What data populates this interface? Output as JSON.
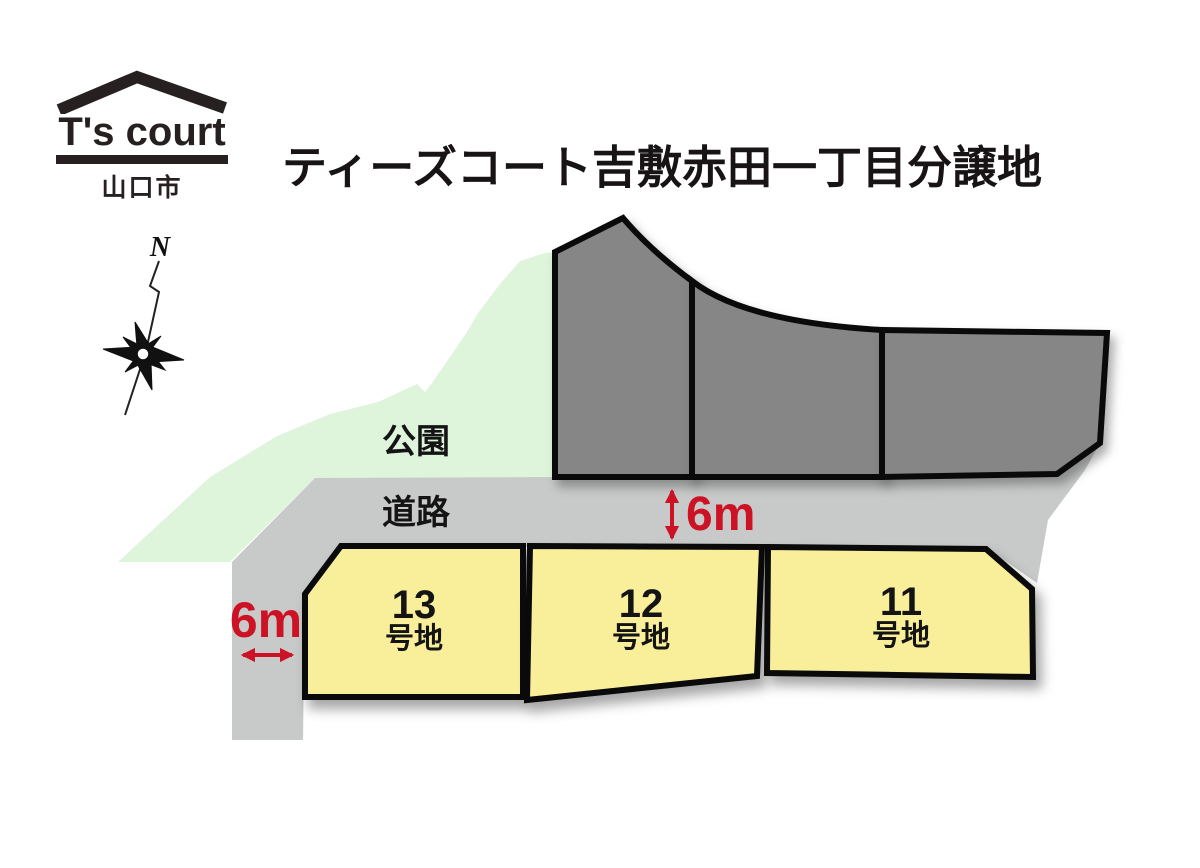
{
  "logo": {
    "brand": "T's court",
    "city": "山口市"
  },
  "title": "ティーズコート吉敷赤田一丁目分譲地",
  "compass": {
    "north_label": "N"
  },
  "map": {
    "park_label": "公園",
    "road_label": "道路",
    "road_width_label": "6m",
    "side_road_width_label": "6m",
    "lots": [
      {
        "number": "13",
        "suffix": "号地"
      },
      {
        "number": "12",
        "suffix": "号地"
      },
      {
        "number": "11",
        "suffix": "号地"
      }
    ],
    "colors": {
      "lot_fill": "#f9ee9a",
      "lot_outline": "#0a0a0a",
      "reserved_lot_fill": "#868686",
      "road_fill": "#c8cac9",
      "park_fill": "#def5dc",
      "dimension_red": "#cd1225"
    }
  }
}
